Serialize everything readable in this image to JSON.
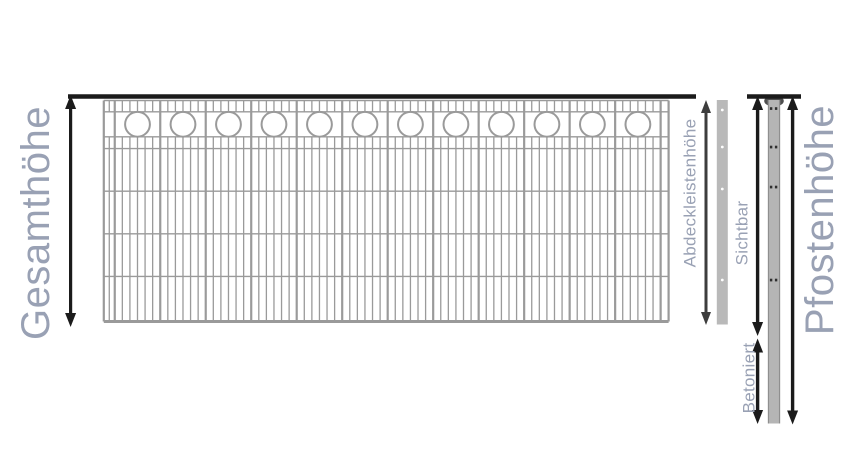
{
  "diagram": {
    "title": "Fence height dimension diagram",
    "labels": {
      "gesamthoehe": "Gesamthöhe",
      "abdeckleistenhoehe": "Abdeckleistenhöhe",
      "sichtbar": "Sichtbar",
      "betoniert": "Betoniert",
      "pfostenhoehe": "Pfostenhöhe"
    },
    "colors": {
      "label_text": "#99a1b4",
      "fence_wire": "#9a9a9a",
      "arrow_black": "#1b1b1b",
      "arrow_dark_gray": "#3d3d3d",
      "strip_fill": "#b9b9b9",
      "post_fill": "#b5b5b5",
      "post_edge": "#8f8f8f",
      "post_cap": "#4e4e4e",
      "hole_dark": "#2f2f2f",
      "hole_light": "#ffffff"
    }
  }
}
